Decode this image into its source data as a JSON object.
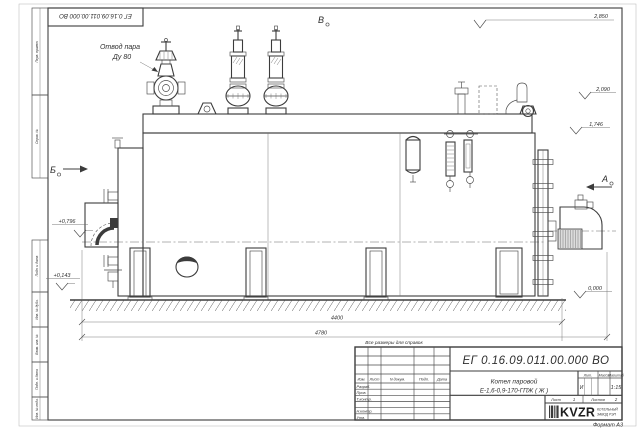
{
  "frame": {
    "format_label": "Формат А3",
    "margin_top_cells": [
      "Перв. примен.",
      "Справ. №"
    ],
    "margin_bottom_cells": [
      "Подп. и дата",
      "Инв. № дубл.",
      "Взам. инв. №",
      "Подп. и дата",
      "Инв. № подл."
    ]
  },
  "drawing": {
    "callout": {
      "line1": "Отвод пара",
      "line2": "Ду 80"
    },
    "views": {
      "a": "А",
      "b": "Б",
      "v": "В"
    },
    "elevations": {
      "top": "2,850",
      "mid_upper": "2,090",
      "mid": "1,746",
      "left_upper": "+0,796",
      "left_lower": "+0,143",
      "ground": "0,000"
    },
    "dimensions": {
      "length_boiler": "4400",
      "length_overall": "4780"
    },
    "note": "Все размеры для справок"
  },
  "title_block": {
    "doc_number": "ЕГ 0.16.09.011.00.000  ВО",
    "name_line1": "Котел паровой",
    "name_line2": "Е-1,6-0,9-170-ГПЖ ( Ж )",
    "columns": {
      "izm": "Изм.",
      "list": "Лист",
      "ndocum": "N докум.",
      "podp": "Подп.",
      "data": "Дата"
    },
    "rows": {
      "razrab": "Разраб.",
      "prov": "Пров.",
      "tkontr": "Т.контр.",
      "nkontr": "Н.контр.",
      "utv": "Утв."
    },
    "lit": {
      "header": "Лит.",
      "value": "И"
    },
    "massa": {
      "header": "Масса"
    },
    "scale": {
      "header": "Масштаб",
      "value": "1:15"
    },
    "sheet": {
      "label": "Лист",
      "value": "1"
    },
    "sheets": {
      "label": "Листов",
      "value": "2"
    },
    "company": {
      "logo": "KVZR",
      "line1": "КОТЕЛЬНЫЙ",
      "line2": "ЗАВОД РЭП"
    }
  }
}
